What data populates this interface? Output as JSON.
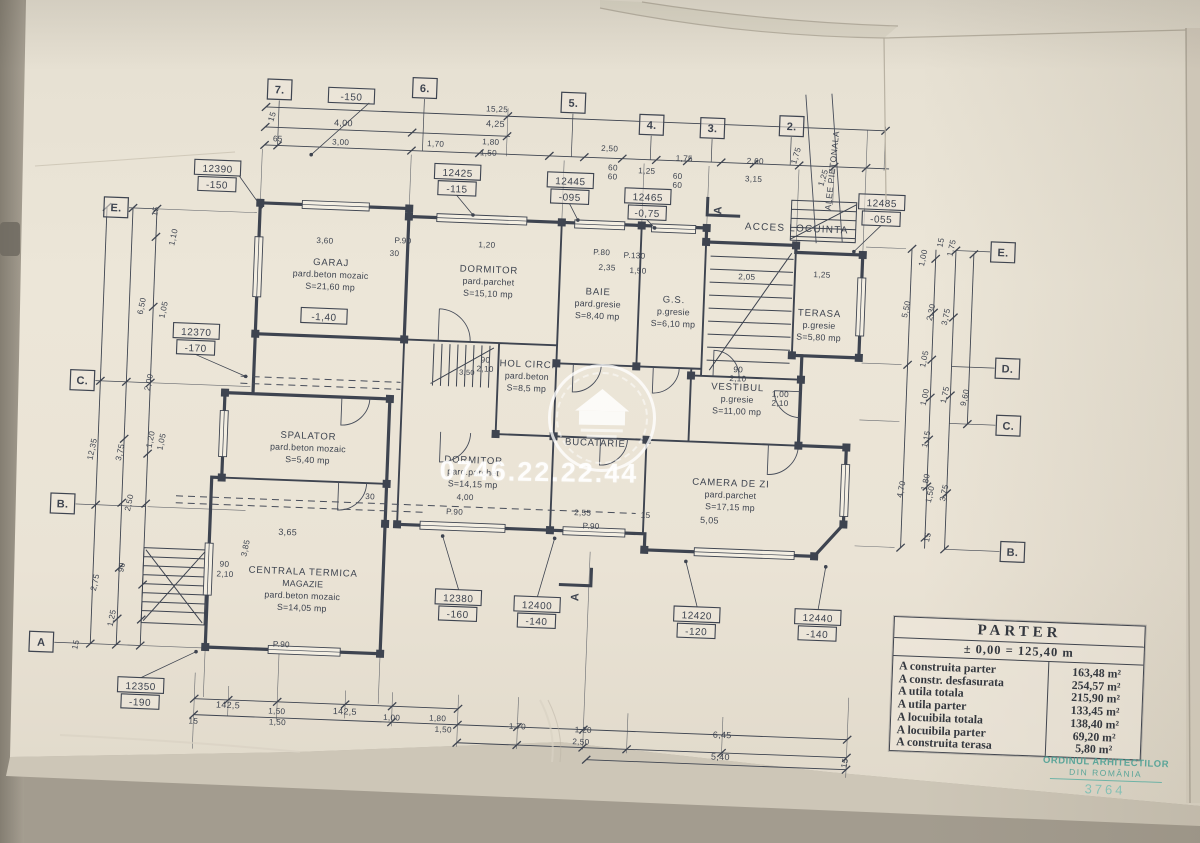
{
  "watermark": {
    "phone": "0746.22.22.44"
  },
  "site_labels": {
    "acces": "ACCES LOCUINTA",
    "alee": "ALEE PIETONALA"
  },
  "section_label": "A",
  "table": {
    "title": "PARTER",
    "subtitle": "± 0,00 = 125,40 m",
    "rows": [
      [
        "A construita parter",
        "163,48 m²"
      ],
      [
        "A constr. desfasurata",
        "254,57 m²"
      ],
      [
        "A utila totala",
        "215,90 m²"
      ],
      [
        "A utila parter",
        "133,45 m²"
      ],
      [
        "A locuibila totala",
        "138,40 m²"
      ],
      [
        "A locuibila parter",
        "69,20 m²"
      ],
      [
        "A construita terasa",
        "5,80 m²"
      ]
    ]
  },
  "stamp": {
    "line1": "ORDINUL ARHITECTILOR",
    "line2": "DIN ROMÂNIA",
    "number": "3764"
  },
  "axes": [
    {
      "label": "7.",
      "x": 268,
      "y": 102,
      "side": "t"
    },
    {
      "label": "6.",
      "x": 413,
      "y": 95,
      "side": "t"
    },
    {
      "label": "5.",
      "x": 562,
      "y": 104,
      "side": "t"
    },
    {
      "label": "4.",
      "x": 641,
      "y": 123,
      "side": "t"
    },
    {
      "label": "3.",
      "x": 702,
      "y": 124,
      "side": "t"
    },
    {
      "label": "2.",
      "x": 781,
      "y": 119,
      "side": "t"
    },
    {
      "label": "E.",
      "x": 109,
      "y": 226,
      "side": "l"
    },
    {
      "label": "C.",
      "x": 82,
      "y": 400,
      "side": "l"
    },
    {
      "label": "B.",
      "x": 67,
      "y": 524,
      "side": "l"
    },
    {
      "label": "A",
      "x": 51,
      "y": 663,
      "side": "l"
    },
    {
      "label": "E.",
      "x": 997,
      "y": 237,
      "side": "r"
    },
    {
      "label": "D.",
      "x": 1006,
      "y": 353,
      "side": "r"
    },
    {
      "label": "C.",
      "x": 1009,
      "y": 410,
      "side": "r"
    },
    {
      "label": "B.",
      "x": 1018,
      "y": 536,
      "side": "r"
    }
  ],
  "markers": [
    {
      "v": "12390",
      "l": "-150",
      "x": 209,
      "y": 183
    },
    {
      "v": "-150",
      "x": 340,
      "y": 106
    },
    {
      "v": "12425",
      "l": "-115",
      "x": 449,
      "y": 178
    },
    {
      "v": "12445",
      "l": "-095",
      "x": 562,
      "y": 182
    },
    {
      "v": "12465",
      "l": "-0,75",
      "x": 640,
      "y": 195
    },
    {
      "v": "12485",
      "l": "-055",
      "x": 874,
      "y": 192
    },
    {
      "v": "12370",
      "l": "-170",
      "x": 194,
      "y": 347
    },
    {
      "v": "12350",
      "l": "-190",
      "x": 152,
      "y": 703
    },
    {
      "v": "12380",
      "l": "-160",
      "x": 466,
      "y": 603
    },
    {
      "v": "12400",
      "l": "-140",
      "x": 545,
      "y": 607
    },
    {
      "v": "12420",
      "l": "-120",
      "x": 705,
      "y": 611
    },
    {
      "v": "12440",
      "l": "-140",
      "x": 826,
      "y": 609
    },
    {
      "v": "-1,40",
      "x": 321,
      "y": 327
    }
  ],
  "rooms": [
    {
      "lines": [
        "GARAJ",
        "pard.beton mozaic",
        "S=21,60 mp"
      ],
      "x": 326,
      "y": 276
    },
    {
      "lines": [
        "DORMITOR",
        "pard.parchet",
        "S=15,10 mp"
      ],
      "x": 484,
      "y": 277
    },
    {
      "lines": [
        "BAIE",
        "pard.gresie",
        "S=8,40 mp"
      ],
      "x": 594,
      "y": 295
    },
    {
      "lines": [
        "G.S.",
        "p.gresie",
        "S=6,10 mp"
      ],
      "x": 670,
      "y": 300
    },
    {
      "lines": [
        "TERASA",
        "p.gresie",
        "S=5,80 mp"
      ],
      "x": 816,
      "y": 308
    },
    {
      "lines": [
        "HOL CIRC.",
        "pard.beton",
        "S=8,5 mp"
      ],
      "x": 526,
      "y": 370
    },
    {
      "lines": [
        "VESTIBUL",
        "p.gresie",
        "S=11,00 mp"
      ],
      "x": 737,
      "y": 385
    },
    {
      "lines": [
        "SPALATOR",
        "pard.beton mozaic",
        "S=5,40 mp"
      ],
      "x": 310,
      "y": 450
    },
    {
      "lines": [
        "DORMITOR",
        "pard.parchet",
        "S=14,15 mp"
      ],
      "x": 476,
      "y": 468
    },
    {
      "lines": [
        "BUCATARIE"
      ],
      "x": 597,
      "y": 446
    },
    {
      "lines": [
        "CAMERA DE ZI",
        "pard.parchet",
        "S=17,15 mp"
      ],
      "x": 734,
      "y": 481
    },
    {
      "lines": [
        "CENTRALA TERMICA",
        "MAGAZIE",
        "pard.beton mozaic",
        "S=14,05 mp"
      ],
      "x": 310,
      "y": 586
    }
  ],
  "dims": [
    {
      "t": "15",
      "x": 264,
      "y": 130,
      "r": -75
    },
    {
      "t": "15,25",
      "x": 486,
      "y": 116
    },
    {
      "t": "4,00",
      "x": 333,
      "y": 136,
      "s": 9
    },
    {
      "t": "4,25",
      "x": 485,
      "y": 131,
      "s": 9
    },
    {
      "t": "65",
      "x": 268,
      "y": 154
    },
    {
      "t": "3,00",
      "x": 331,
      "y": 155
    },
    {
      "t": "1,70",
      "x": 426,
      "y": 153
    },
    {
      "t": "1,80",
      "x": 481,
      "y": 149
    },
    {
      "t": "1,50",
      "x": 479,
      "y": 160
    },
    {
      "t": "2,50",
      "x": 600,
      "y": 151
    },
    {
      "t": "60",
      "x": 604,
      "y": 170
    },
    {
      "t": "60",
      "x": 604,
      "y": 179
    },
    {
      "t": "1,25",
      "x": 638,
      "y": 172
    },
    {
      "t": "60",
      "x": 669,
      "y": 176
    },
    {
      "t": "60",
      "x": 669,
      "y": 185
    },
    {
      "t": "1,75",
      "x": 675,
      "y": 158
    },
    {
      "t": "2,60",
      "x": 746,
      "y": 158
    },
    {
      "t": "3,15",
      "x": 745,
      "y": 176
    },
    {
      "t": "1,75",
      "x": 789,
      "y": 149,
      "r": -75
    },
    {
      "t": "1,25",
      "x": 817,
      "y": 170,
      "r": -75
    },
    {
      "t": "15",
      "x": 151,
      "y": 229,
      "r": -80
    },
    {
      "t": "1,10",
      "x": 170,
      "y": 254,
      "r": -80
    },
    {
      "t": "6,50",
      "x": 141,
      "y": 324,
      "r": -80
    },
    {
      "t": "1,05",
      "x": 163,
      "y": 327,
      "r": -80
    },
    {
      "t": "2,00",
      "x": 151,
      "y": 400,
      "r": -80
    },
    {
      "t": "12,35",
      "x": 97,
      "y": 469,
      "r": -80
    },
    {
      "t": "3,75",
      "x": 125,
      "y": 471,
      "r": -80
    },
    {
      "t": "1,20",
      "x": 155,
      "y": 457,
      "r": -80
    },
    {
      "t": "1,05",
      "x": 166,
      "y": 459,
      "r": -80
    },
    {
      "t": "2,50",
      "x": 136,
      "y": 521,
      "r": -80
    },
    {
      "t": "90",
      "x": 131,
      "y": 586,
      "r": -80
    },
    {
      "t": "2,75",
      "x": 105,
      "y": 602,
      "r": -80
    },
    {
      "t": "1,25",
      "x": 123,
      "y": 637,
      "r": -80
    },
    {
      "t": "15",
      "x": 88,
      "y": 665,
      "r": -80
    },
    {
      "t": "15",
      "x": 937,
      "y": 230,
      "r": -80
    },
    {
      "t": "1,75",
      "x": 948,
      "y": 235,
      "r": -80
    },
    {
      "t": "1,00",
      "x": 920,
      "y": 246,
      "r": -80
    },
    {
      "t": "5,50",
      "x": 905,
      "y": 298,
      "r": -80
    },
    {
      "t": "2,30",
      "x": 930,
      "y": 300,
      "r": -80
    },
    {
      "t": "3,75",
      "x": 945,
      "y": 304,
      "r": -80
    },
    {
      "t": "1,05",
      "x": 925,
      "y": 347,
      "r": -80
    },
    {
      "t": "1,00",
      "x": 927,
      "y": 385,
      "r": -80
    },
    {
      "t": "1,75",
      "x": 947,
      "y": 382,
      "r": -80
    },
    {
      "t": "9,60",
      "x": 967,
      "y": 384,
      "r": -80
    },
    {
      "t": "1,15",
      "x": 930,
      "y": 427,
      "r": -80
    },
    {
      "t": "4,70",
      "x": 907,
      "y": 478,
      "r": -80
    },
    {
      "t": "1,80",
      "x": 931,
      "y": 470,
      "r": -80
    },
    {
      "t": "1,50",
      "x": 936,
      "y": 482,
      "r": -80
    },
    {
      "t": "3,75",
      "x": 950,
      "y": 480,
      "r": -80
    },
    {
      "t": "15",
      "x": 935,
      "y": 525,
      "r": -80
    },
    {
      "t": "P.90",
      "x": 291,
      "y": 659
    },
    {
      "t": "142,5",
      "x": 240,
      "y": 722,
      "s": 9
    },
    {
      "t": "15",
      "x": 206,
      "y": 739
    },
    {
      "t": "1,50",
      "x": 289,
      "y": 726
    },
    {
      "t": "1,50",
      "x": 290,
      "y": 737
    },
    {
      "t": "142,5",
      "x": 357,
      "y": 724,
      "s": 9
    },
    {
      "t": "1,00",
      "x": 404,
      "y": 728
    },
    {
      "t": "1,80",
      "x": 450,
      "y": 727
    },
    {
      "t": "1,50",
      "x": 456,
      "y": 738
    },
    {
      "t": "1,70",
      "x": 530,
      "y": 732
    },
    {
      "t": "1,20",
      "x": 596,
      "y": 733
    },
    {
      "t": "2,50",
      "x": 594,
      "y": 745
    },
    {
      "t": "6,45",
      "x": 735,
      "y": 733,
      "s": 9
    },
    {
      "t": "5,40",
      "x": 734,
      "y": 755,
      "s": 9
    },
    {
      "t": "15",
      "x": 861,
      "y": 754,
      "r": -80
    },
    {
      "t": "3,60",
      "x": 319,
      "y": 254
    },
    {
      "t": "P.90",
      "x": 397,
      "y": 251
    },
    {
      "t": "1,20",
      "x": 481,
      "y": 252
    },
    {
      "t": "P.80",
      "x": 596,
      "y": 255
    },
    {
      "t": "2,35",
      "x": 602,
      "y": 270
    },
    {
      "t": "P.130",
      "x": 629,
      "y": 257
    },
    {
      "t": "1,50",
      "x": 633,
      "y": 272
    },
    {
      "t": "2,05",
      "x": 742,
      "y": 274
    },
    {
      "t": "1,25",
      "x": 817,
      "y": 269
    },
    {
      "t": "90",
      "x": 737,
      "y": 367
    },
    {
      "t": "2,10",
      "x": 737,
      "y": 376
    },
    {
      "t": "1,00",
      "x": 780,
      "y": 390
    },
    {
      "t": "2,10",
      "x": 780,
      "y": 399
    },
    {
      "t": "90",
      "x": 484,
      "y": 367
    },
    {
      "t": "2,10",
      "x": 484,
      "y": 376
    },
    {
      "t": "30",
      "x": 389,
      "y": 264
    },
    {
      "t": "3,50",
      "x": 466,
      "y": 380,
      "s": 7.5
    },
    {
      "t": "4,00",
      "x": 469,
      "y": 505
    },
    {
      "t": "P.90",
      "x": 459,
      "y": 520
    },
    {
      "t": "2,55",
      "x": 587,
      "y": 516
    },
    {
      "t": "P.90",
      "x": 596,
      "y": 529
    },
    {
      "t": "15",
      "x": 650,
      "y": 516
    },
    {
      "t": "5,05",
      "x": 714,
      "y": 519,
      "s": 9
    },
    {
      "t": "3,65",
      "x": 293,
      "y": 547,
      "s": 9
    },
    {
      "t": "3,85",
      "x": 254,
      "y": 562,
      "r": -80
    },
    {
      "t": "90",
      "x": 231,
      "y": 581
    },
    {
      "t": "2,10",
      "x": 232,
      "y": 591
    },
    {
      "t": "30",
      "x": 374,
      "y": 508
    }
  ]
}
